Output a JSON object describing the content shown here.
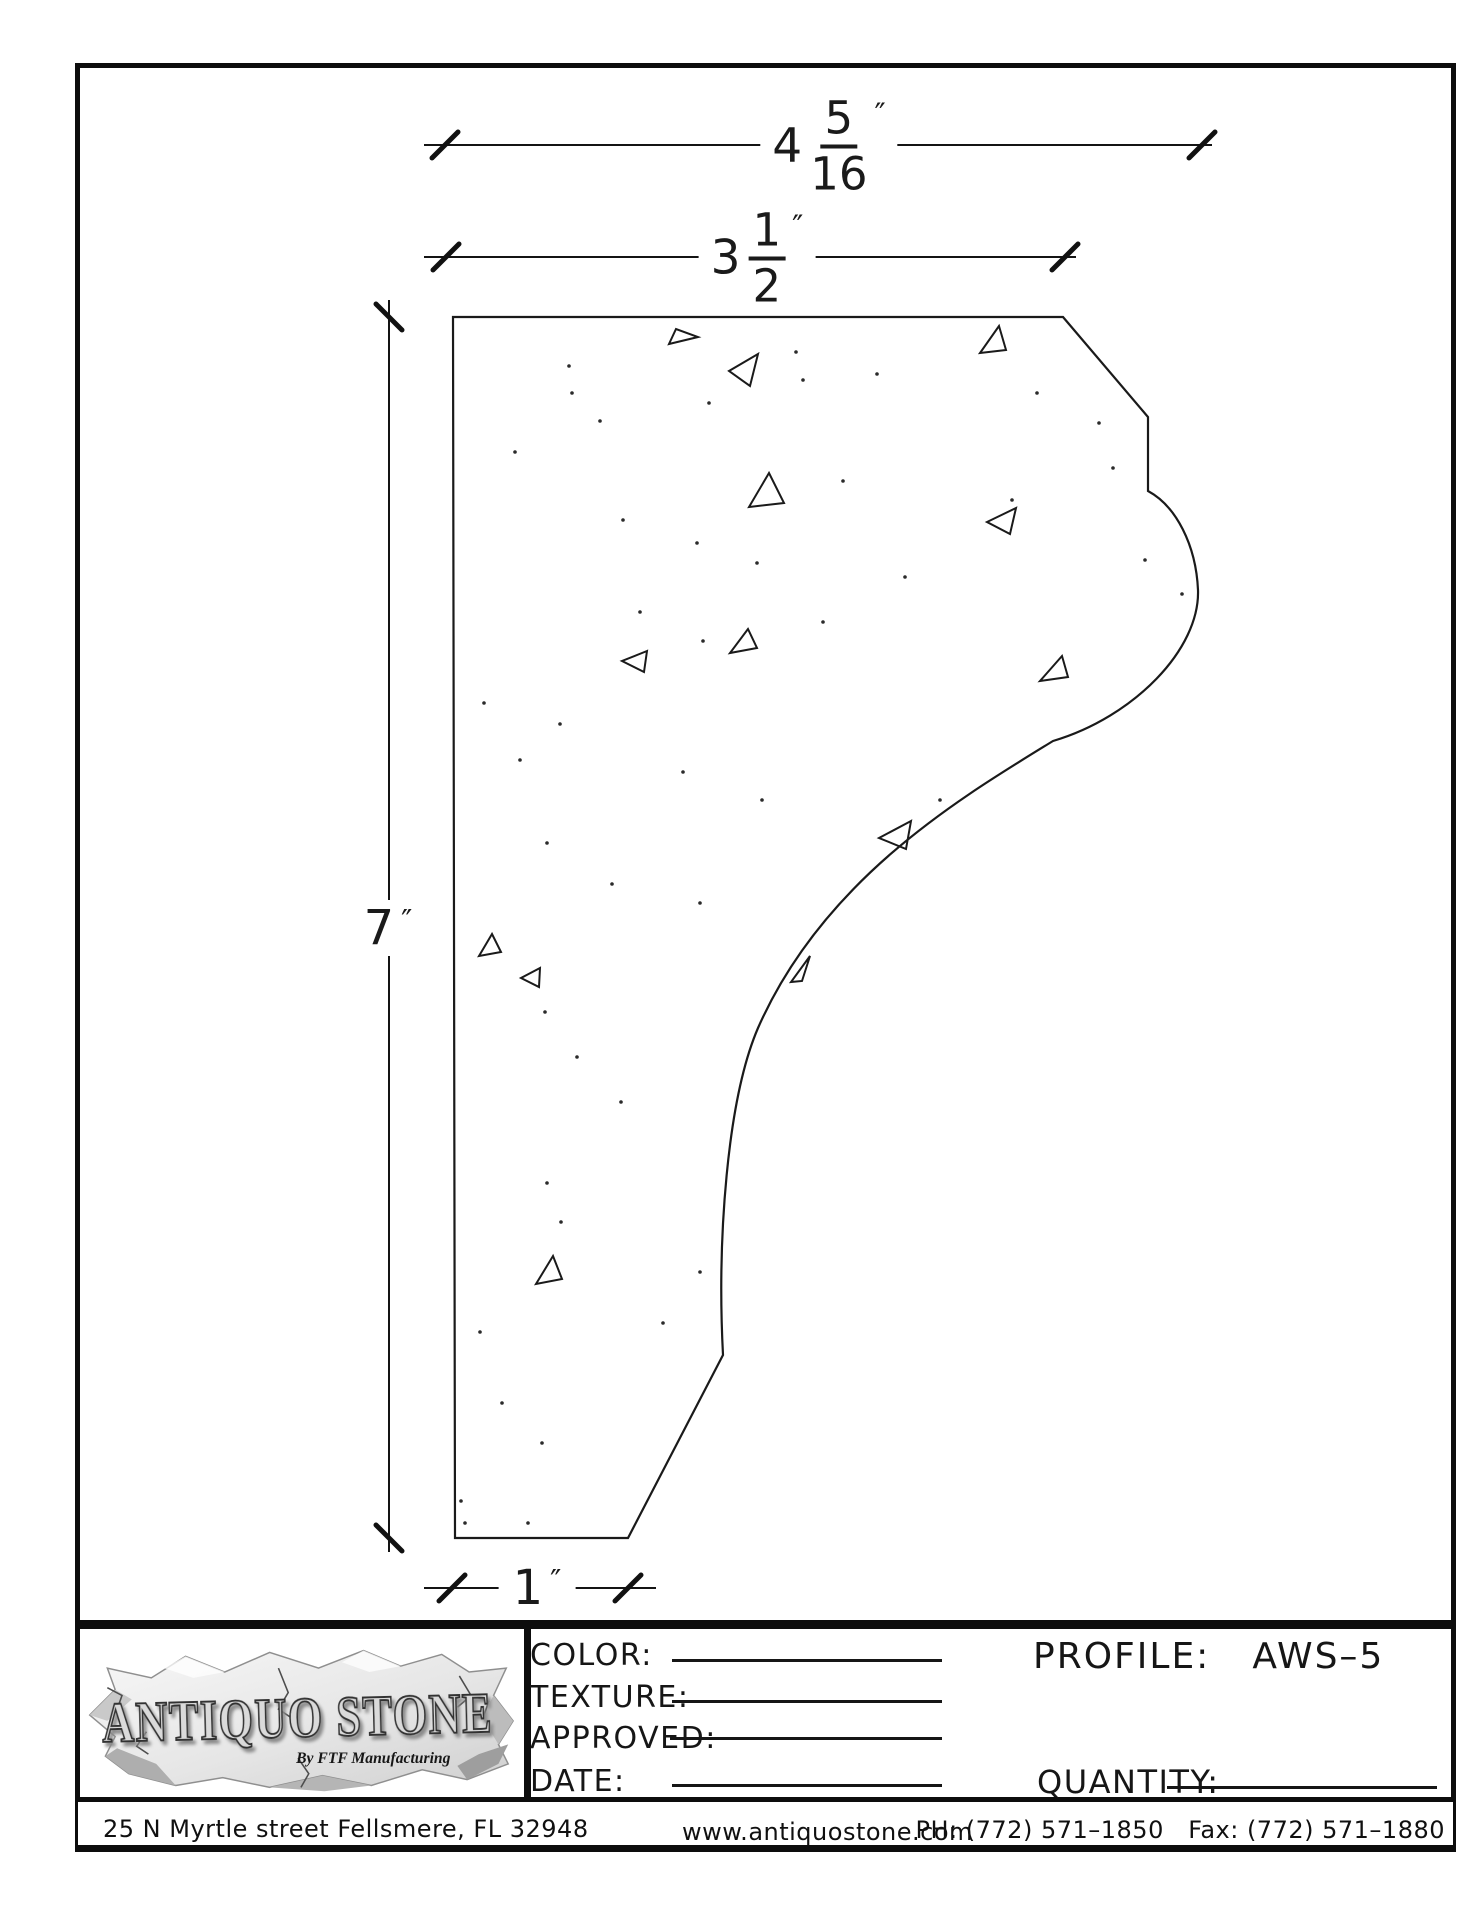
{
  "dims": {
    "overall": {
      "whole": "4",
      "num": "5",
      "den": "16",
      "unit": "″"
    },
    "top": {
      "whole": "3",
      "num": "1",
      "den": "2",
      "unit": "″"
    },
    "height": {
      "value": "7",
      "unit": "″"
    },
    "bottom": {
      "value": "1",
      "unit": "″"
    }
  },
  "title_block": {
    "logo": {
      "brand": "ANTIQUO STONE",
      "byline": "By FTF Manufacturing"
    },
    "fields": [
      {
        "label": "COLOR:",
        "value": ""
      },
      {
        "label": "TEXTURE:",
        "value": ""
      },
      {
        "label": "APPROVED:",
        "value": ""
      },
      {
        "label": "DATE:",
        "value": ""
      }
    ],
    "profile_label": "PROFILE:",
    "profile_value": "AWS–5",
    "quantity_label": "QUANTITY:"
  },
  "footer": {
    "address": "25 N Myrtle street Fellsmere, FL 32948",
    "website": "www.antiquostone.com",
    "phone": "PH: (772) 571–1850   Fax: (772) 571–1880"
  },
  "colors": {
    "ink": "#0d0d0d",
    "stone_light": "#f5f5f5",
    "stone_dark": "#cfcfcf"
  }
}
